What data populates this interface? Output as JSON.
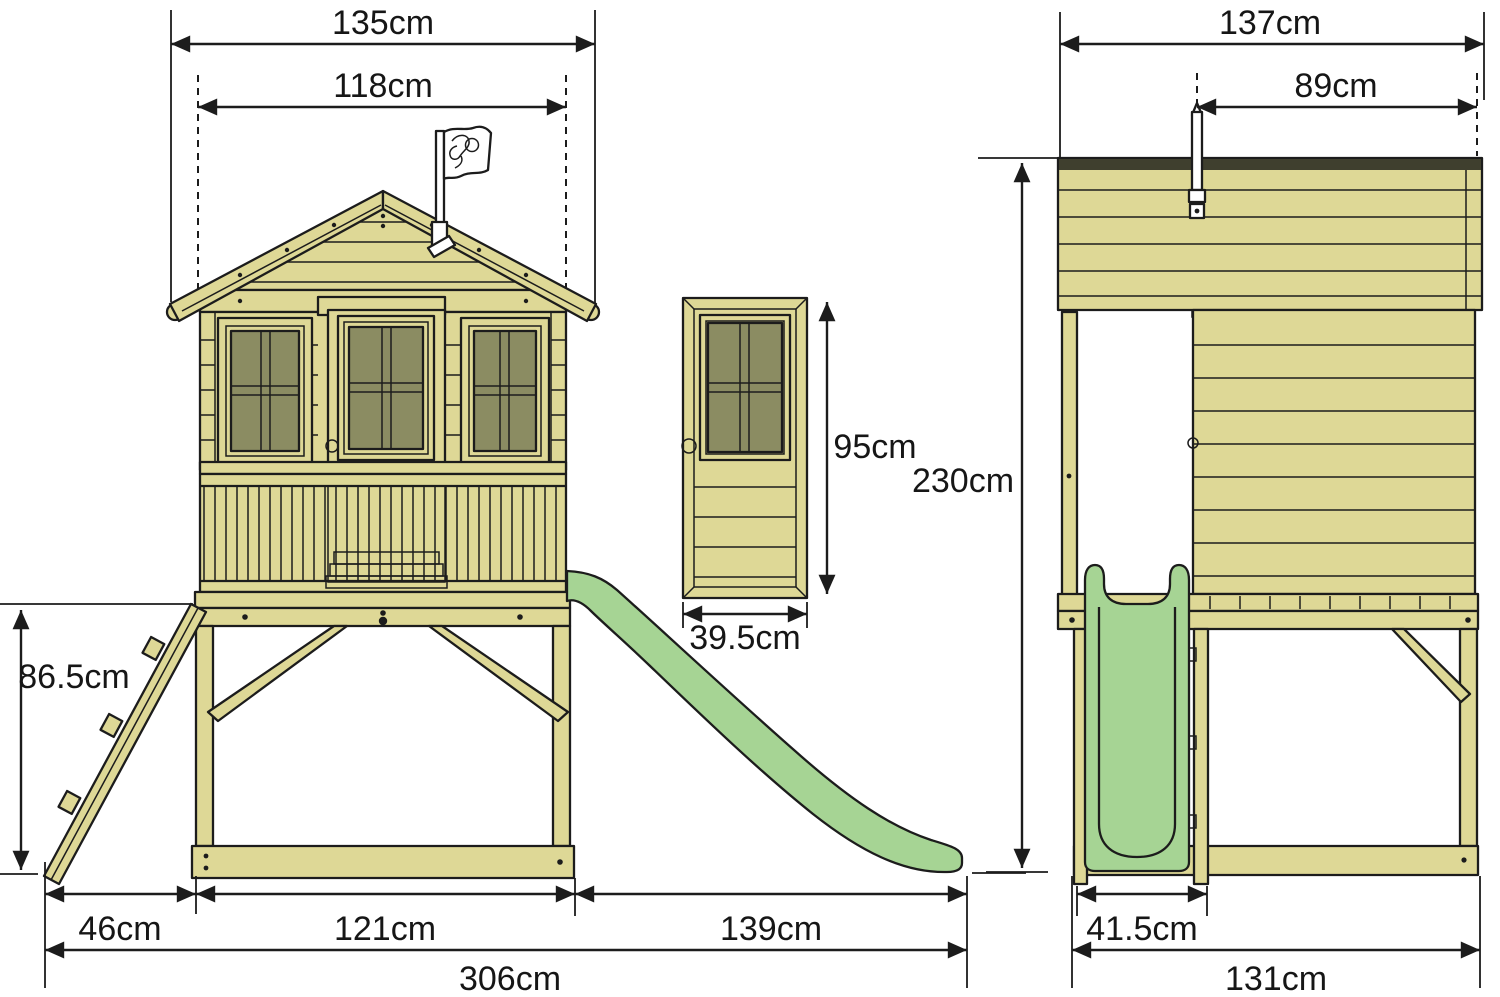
{
  "figure": {
    "type": "product-dimension-diagram",
    "subject": "wooden-stilt-playhouse-with-slide-and-ladder",
    "views": [
      "front-elevation",
      "door-detail",
      "side-elevation"
    ]
  },
  "colors": {
    "bg": "#ffffff",
    "wood": "#ded896",
    "glass": "#8b8c62",
    "slide": "#a6d494",
    "dark": "#3f3f2e",
    "line": "#1c1c1c"
  },
  "icons": {
    "flag_logo": "tp-toys-brand-flag"
  },
  "dims": {
    "front": {
      "roof_width": "135cm",
      "wall_width": "118cm",
      "ladder_height": "86.5cm",
      "ladder_base": "46cm",
      "base_width": "121cm",
      "slide_run": "139cm",
      "total_width": "306cm"
    },
    "door": {
      "height": "95cm",
      "width": "39.5cm"
    },
    "side": {
      "roof_depth": "137cm",
      "roof_to_back": "89cm",
      "total_height": "230cm",
      "slide_width": "41.5cm",
      "base_depth": "131cm"
    }
  }
}
